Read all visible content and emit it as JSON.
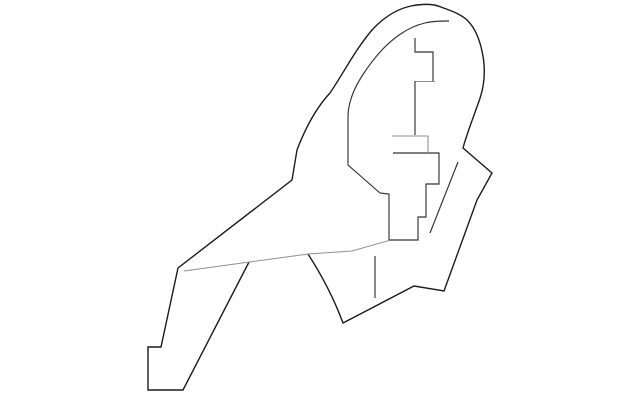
{
  "page": {
    "background": "#ffffff",
    "width": 640,
    "height": 401
  },
  "artwork": {
    "kind": "monochrome-part-line-drawing",
    "viewbox": "0 0 640 401",
    "colors": {
      "outline": "#1c1c1c",
      "detail": "#333333",
      "faint": "#8f8f8f"
    },
    "paths": [
      {
        "name": "outer-body-outline",
        "color_key": "outline",
        "width": 1.4,
        "d": "M 249,262 L 183,390 L 148,390 L 148,347 L 161,347 L 178,268 L 292,180 L 297,150 C 305,129 316,108 330,93 C 343,74 355,50 372,30 C 384,17 397,9 411,6 C 424,3.5 434,4 441,7 C 450,10.5 460,13.5 467,20 C 476,28.5 481,43 483.5,59 C 486,79 482.5,93 476.5,108 C 471.5,122.5 466.5,135 463,148 L 492,173 L 477,200 L 444,291 L 414,286 L 343,323 Q 330,288 308,254"
      },
      {
        "name": "inner-cutout-outline",
        "color_key": "detail",
        "width": 1.15,
        "d": "M 449,21 C 441,21 433,21 425,23 C 407,27 391,40 381,51 C 371,62 356,82 351,99 C 349,105 348,111 348,117 L 348,165 L 380,193 L 389,194 L 389,240 L 418,240 L 418,217 L 426,217 L 426,184 L 439,184 L 439,153 L 393,153"
      },
      {
        "name": "upper-step-cutout",
        "color_key": "detail",
        "width": 1.15,
        "d": "M 415,38 L 415,52 L 433,52 L 433,81"
      },
      {
        "name": "upper-step-gray-ledge",
        "color_key": "faint",
        "width": 1.1,
        "d": "M 435,81.5 L 415,81.5"
      },
      {
        "name": "upper-step-stem",
        "color_key": "detail",
        "width": 1.15,
        "d": "M 415,81 L 415,135"
      },
      {
        "name": "mid-step-gray-spur",
        "color_key": "faint",
        "width": 1.1,
        "d": "M 392,136 L 428,136 L 428,153"
      },
      {
        "name": "hatch-diagonal-line",
        "color_key": "detail",
        "width": 1.15,
        "d": "M 458,162 L 430,233"
      },
      {
        "name": "short-vertical-detail-line",
        "color_key": "detail",
        "width": 1.15,
        "d": "M 375,256 L 375,298"
      },
      {
        "name": "lower-seam-line",
        "color_key": "faint",
        "width": 0.95,
        "d": "M 184,271 L 308,254 L 352,251 L 389,240.5"
      }
    ]
  }
}
